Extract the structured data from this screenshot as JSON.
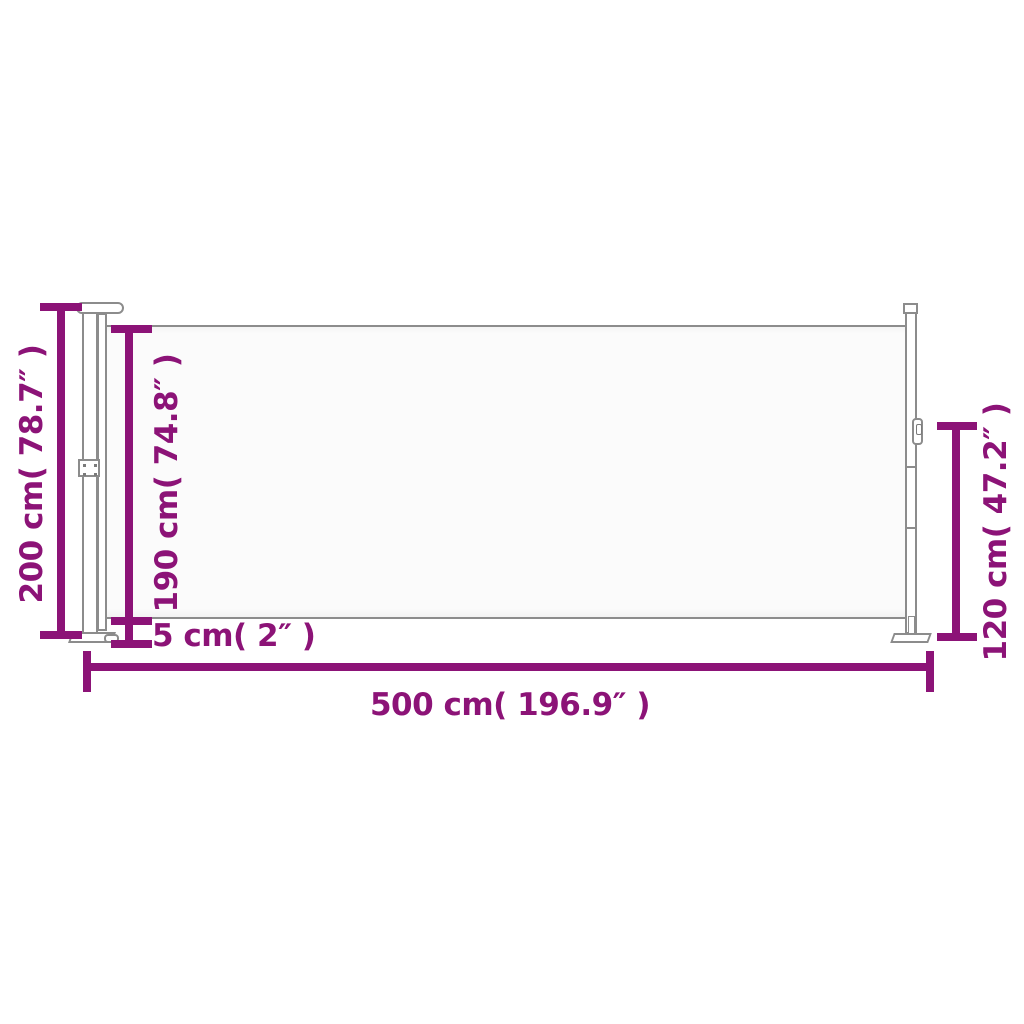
{
  "diagram": {
    "style": {
      "accent_color": "#8C1377",
      "line_color": "#8C8C8C",
      "fabric_fill": "#FBFBFB",
      "background": "#FFFFFF"
    },
    "dimensions": {
      "overall_height": {
        "label": "200 cm( 78.7″ )",
        "cm": 200,
        "inch": 78.7
      },
      "fabric_height": {
        "label": "190 cm( 74.8″ )",
        "cm": 190,
        "inch": 74.8
      },
      "bottom_gap": {
        "label": "5 cm( 2″ )",
        "cm": 5,
        "inch": 2
      },
      "total_width": {
        "label": "500 cm( 196.9″ )",
        "cm": 500,
        "inch": 196.9
      },
      "end_post_height": {
        "label": "120 cm( 47.2″ )",
        "cm": 120,
        "inch": 47.2
      }
    }
  }
}
